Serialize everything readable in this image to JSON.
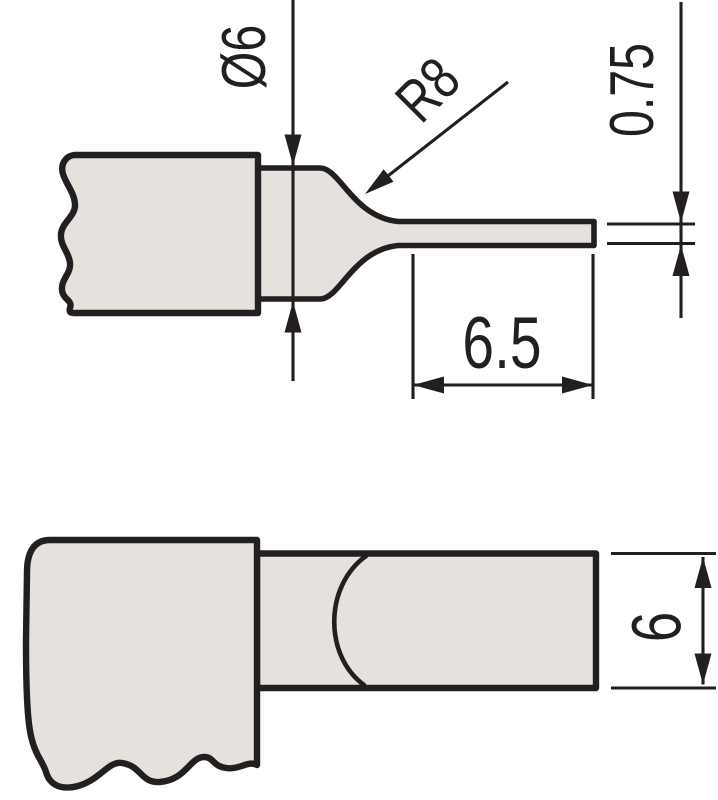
{
  "labels": {
    "neck_diameter": "Ø6",
    "tip_radius": "R8",
    "blade_thickness": "0.75",
    "blade_length": "6.5",
    "blade_width": "6"
  },
  "colors": {
    "background": "#ffffff",
    "part_fill": "#e5e1dd",
    "line": "#231f20"
  }
}
